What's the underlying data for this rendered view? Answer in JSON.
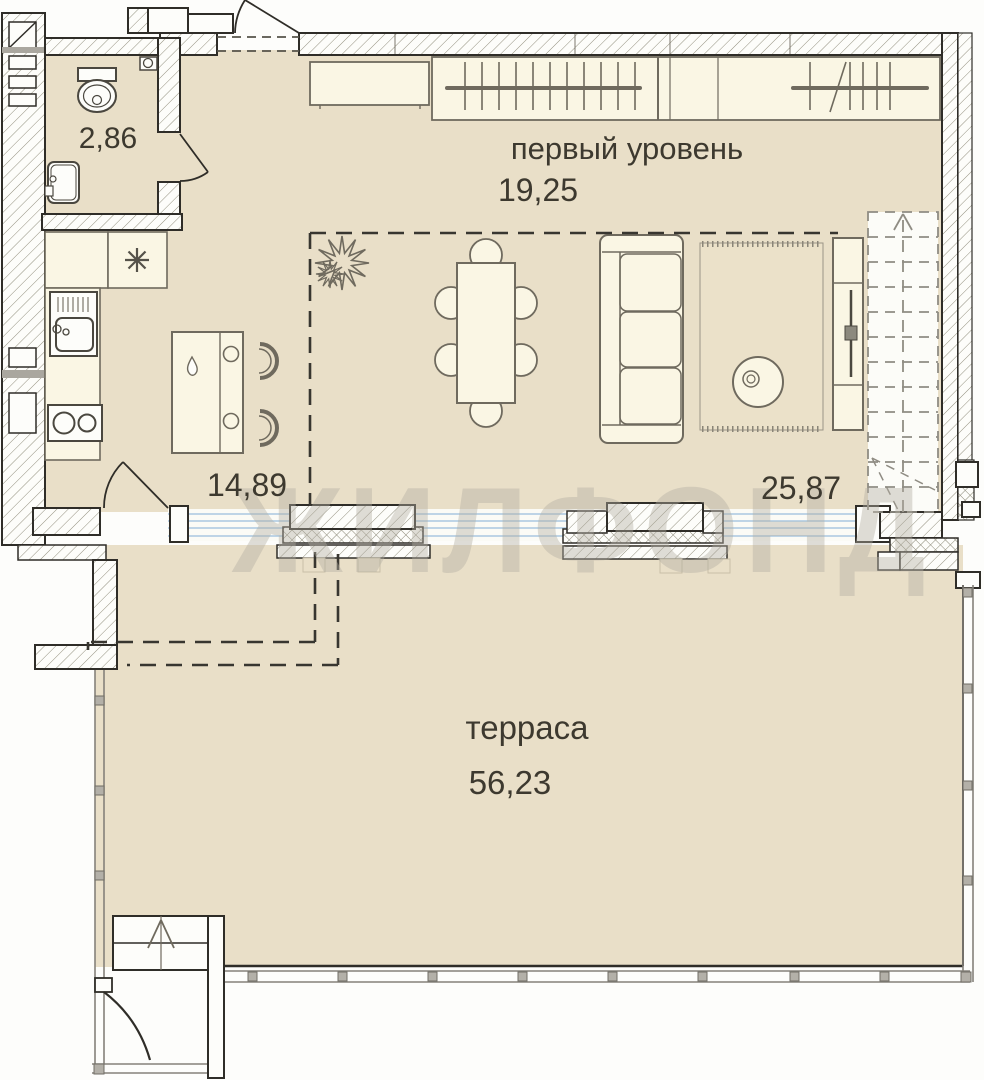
{
  "watermark": "ЖИЛФОНД",
  "rooms": {
    "bathroom": {
      "area": "2,86"
    },
    "first_level": {
      "name": "первый уровень",
      "area": "19,25"
    },
    "kitchen": {
      "area": "14,89"
    },
    "living": {
      "area": "25,87"
    },
    "terrace": {
      "name": "терраса",
      "area": "56,23"
    }
  },
  "colors": {
    "floor": "#e9dfc8",
    "furniture": "#faf6e4",
    "wall_outline": "#2f2d28",
    "hatch_line": "#93907f",
    "glass_blue": "#a9c8e0",
    "label_text": "#3d392f",
    "watermark": "#b2ada2",
    "railing": "#85827a"
  }
}
